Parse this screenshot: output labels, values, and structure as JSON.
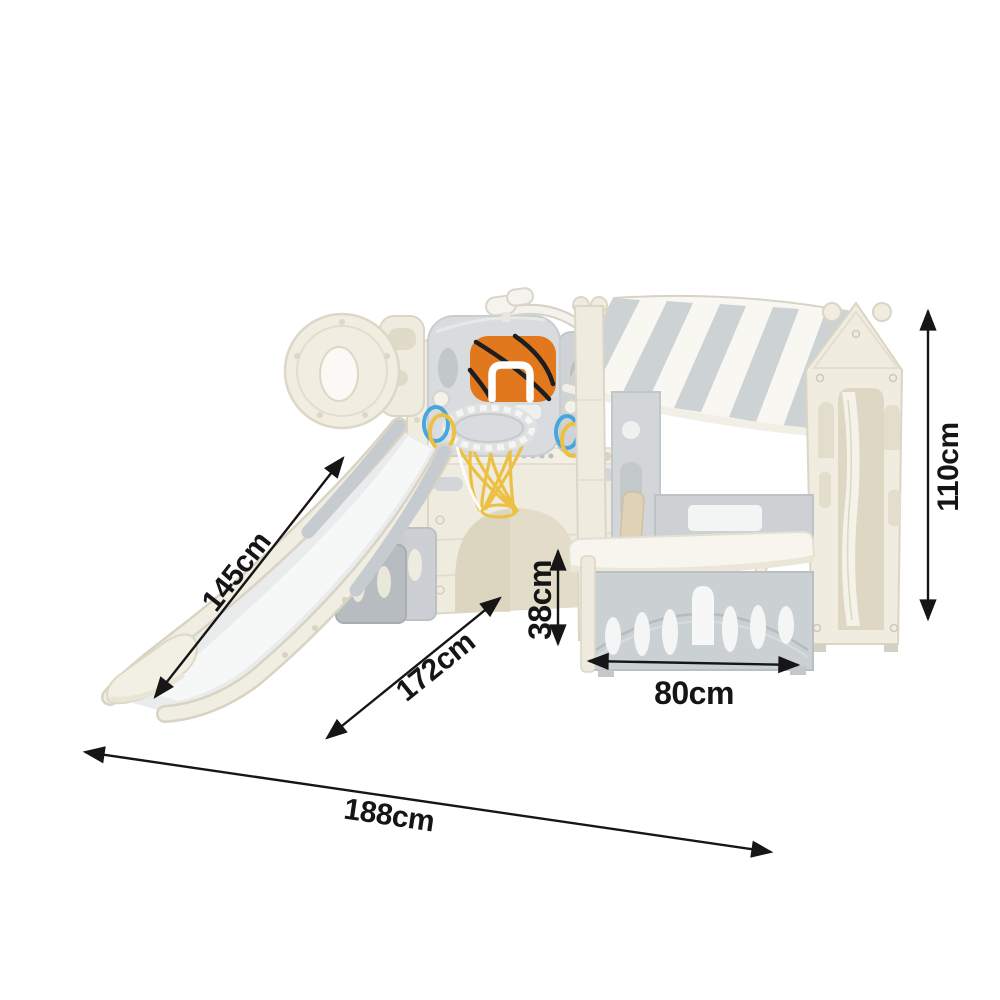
{
  "page": {
    "background_color": "#ffffff"
  },
  "diagram": {
    "kind": "product dimension diagram",
    "subject": "kids slide, basketball hoop and playhouse playset",
    "unit": "cm",
    "dimensions": {
      "slide_length": {
        "label": "145cm",
        "value": 145
      },
      "depth_diagonal": {
        "label": "172cm",
        "value": 172
      },
      "table_height": {
        "label": "38cm",
        "value": 38
      },
      "playhouse_width": {
        "label": "80cm",
        "value": 80
      },
      "overall_height": {
        "label": "110cm",
        "value": 110
      },
      "overall_length": {
        "label": "188cm",
        "value": 188
      }
    },
    "colors": {
      "cream_panel": "#f1ede0",
      "panel_gray": "#d8dbde",
      "fence_gray": "#cbd0d3",
      "awning_stripe_gray": "#cdd2d5",
      "basketball_orange": "#e2781d",
      "net_yellow": "#ecc143",
      "ring_blue": "#47a7dc",
      "annotation_black": "#161616"
    }
  }
}
